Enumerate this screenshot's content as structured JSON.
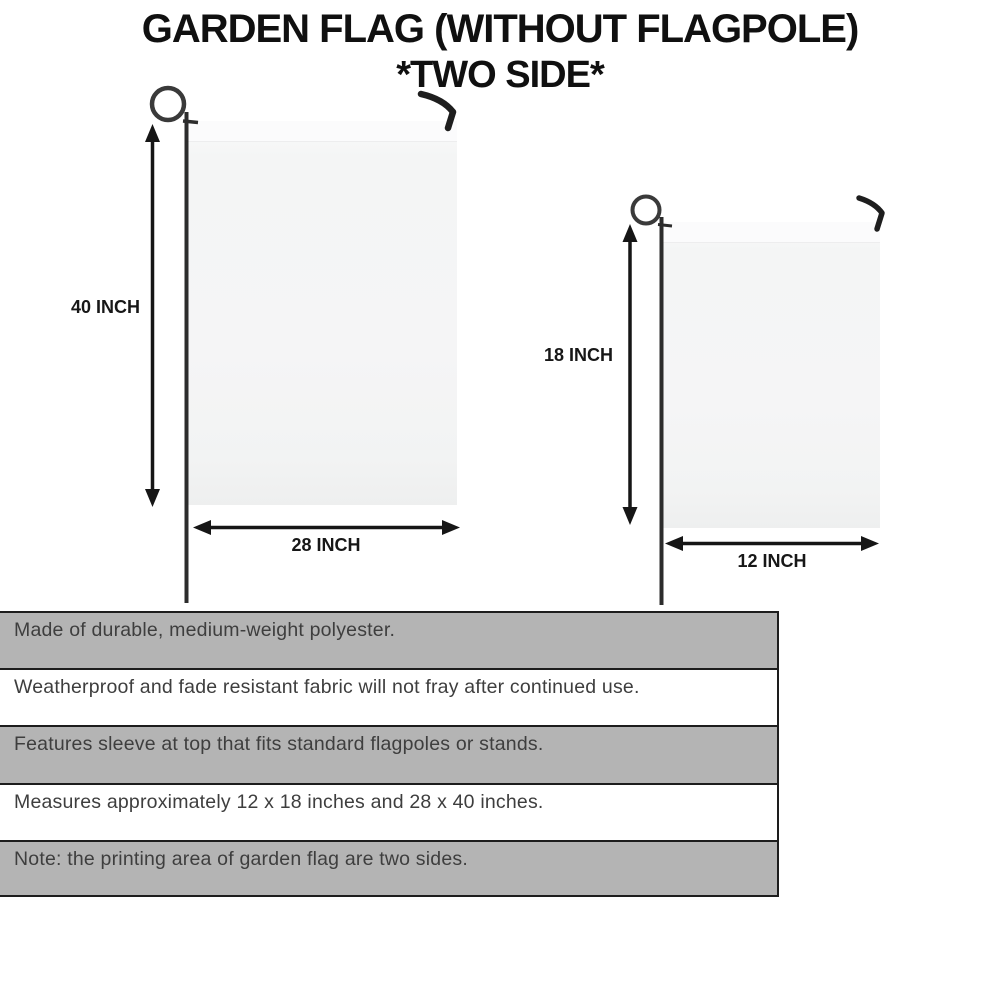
{
  "title": {
    "line1": "GARDEN FLAG (WITHOUT FLAGPOLE)",
    "line2": "*TWO SIDE*"
  },
  "diagram": {
    "large_flag": {
      "height_label": "40 INCH",
      "width_label": "28 INCH"
    },
    "small_flag": {
      "height_label": "18 INCH",
      "width_label": "12 INCH"
    }
  },
  "features": {
    "rows": [
      "Made of durable, medium-weight polyester.",
      "Weatherproof and fade resistant fabric will not fray after continued use.",
      "Features sleeve at top that fits standard flagpoles or stands.",
      "Measures approximately 12 x 18 inches and 28 x 40 inches.",
      "Note: the printing area of garden flag are two sides."
    ]
  },
  "colors": {
    "row_shaded": "#b4b4b4",
    "row_plain": "#ffffff",
    "table_border": "#1d1d1d",
    "body_text": "#3e3e3e",
    "title_text": "#101010",
    "pole": "#2c2c2c",
    "arrow": "#161616",
    "flag_fill": "#f4f5f5"
  }
}
